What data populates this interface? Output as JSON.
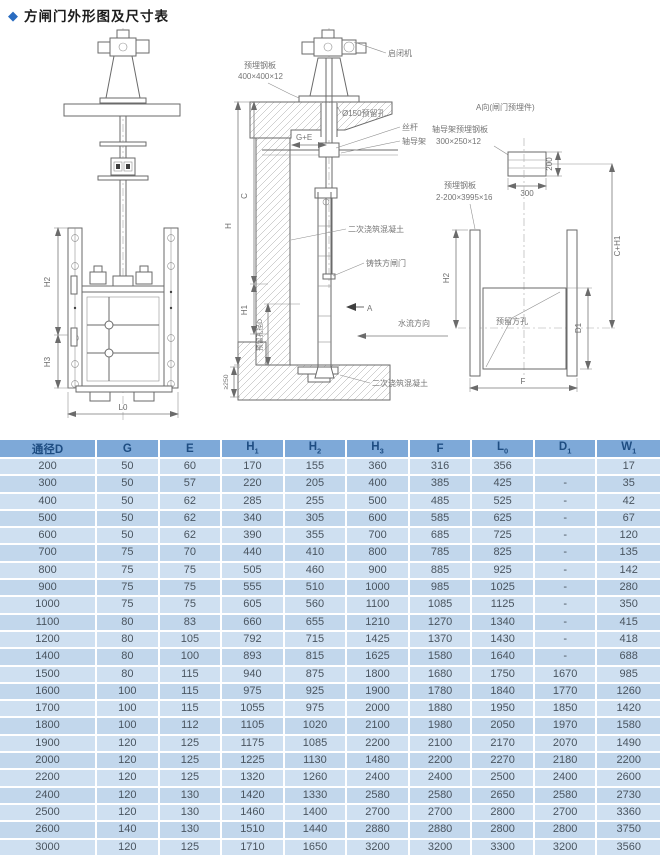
{
  "title": {
    "diamond": "◆",
    "text": "方闸门外形图及尺寸表"
  },
  "colors": {
    "header_bg": "#7ea9d8",
    "header_text": "#1e4d82",
    "row_odd": "#cfe0f1",
    "row_even": "#c2d7ec",
    "accent_diamond": "#2a6cc0"
  },
  "drawing": {
    "front": {
      "dim_h2": "H2",
      "dim_h3": "H3",
      "dim_l0": "L0"
    },
    "section": {
      "hoist": "启闭机",
      "embed_plate": "预埋钢板",
      "embed_plate_size": "400×400×12",
      "hole150": "Ø150预留孔",
      "ge": "G+E",
      "screw": "丝杆",
      "guide": "轴导架",
      "concrete_top": "二次浇筑混凝土",
      "gate": "铸铁方闸门",
      "a_mark": "A",
      "flow": "水流方向",
      "concrete_bottom": "二次浇筑混凝土",
      "dim_h": "H",
      "dim_c": "C",
      "dim_h1": "H1",
      "dim_hole": "预留孔径D",
      "dim_250": "≥250"
    },
    "aview": {
      "title": "A向(闸门预埋件)",
      "guide_plate": "轴导架预埋钢板",
      "guide_plate_size": "300×250×12",
      "embed_plate2": "预埋钢板",
      "embed_plate2_size": "2-200×3995×16",
      "hole_label": "预留方孔",
      "dim_300": "300",
      "dim_200": "200",
      "dim_ch1": "C+H1",
      "dim_h2": "H2",
      "dim_d1": "D1",
      "dim_f": "F"
    }
  },
  "table": {
    "headers": [
      {
        "t": "通径D",
        "s": ""
      },
      {
        "t": "G",
        "s": ""
      },
      {
        "t": "E",
        "s": ""
      },
      {
        "t": "H",
        "s": "1"
      },
      {
        "t": "H",
        "s": "2"
      },
      {
        "t": "H",
        "s": "3"
      },
      {
        "t": "F",
        "s": ""
      },
      {
        "t": "L",
        "s": "0"
      },
      {
        "t": "D",
        "s": "1"
      },
      {
        "t": "W",
        "s": "1"
      }
    ],
    "rows": [
      [
        200,
        50,
        60,
        170,
        155,
        360,
        316,
        356,
        "",
        17
      ],
      [
        300,
        50,
        57,
        220,
        205,
        400,
        385,
        425,
        "-",
        35
      ],
      [
        400,
        50,
        62,
        285,
        255,
        500,
        485,
        525,
        "-",
        42
      ],
      [
        500,
        50,
        62,
        340,
        305,
        600,
        585,
        625,
        "-",
        67
      ],
      [
        600,
        50,
        62,
        390,
        355,
        700,
        685,
        725,
        "-",
        120
      ],
      [
        700,
        75,
        70,
        440,
        410,
        800,
        785,
        825,
        "-",
        135
      ],
      [
        800,
        75,
        75,
        505,
        460,
        900,
        885,
        925,
        "-",
        142
      ],
      [
        900,
        75,
        75,
        555,
        510,
        1000,
        985,
        1025,
        "-",
        280
      ],
      [
        1000,
        75,
        75,
        605,
        560,
        1100,
        1085,
        1125,
        "-",
        350
      ],
      [
        1100,
        80,
        83,
        660,
        655,
        1210,
        1270,
        1340,
        "-",
        415
      ],
      [
        1200,
        80,
        105,
        792,
        715,
        1425,
        1370,
        1430,
        "-",
        418
      ],
      [
        1400,
        80,
        100,
        893,
        815,
        1625,
        1580,
        1640,
        "-",
        688
      ],
      [
        1500,
        80,
        115,
        940,
        875,
        1800,
        1680,
        1750,
        1670,
        985
      ],
      [
        1600,
        100,
        115,
        975,
        925,
        1900,
        1780,
        1840,
        1770,
        1260
      ],
      [
        1700,
        100,
        115,
        1055,
        975,
        2000,
        1880,
        1950,
        1850,
        1420
      ],
      [
        1800,
        100,
        112,
        1105,
        1020,
        2100,
        1980,
        2050,
        1970,
        1580
      ],
      [
        1900,
        120,
        125,
        1175,
        1085,
        2200,
        2100,
        2170,
        2070,
        1490
      ],
      [
        2000,
        120,
        125,
        1225,
        1130,
        1480,
        2200,
        2270,
        2180,
        2200
      ],
      [
        2200,
        120,
        125,
        1320,
        1260,
        2400,
        2400,
        2500,
        2400,
        2600
      ],
      [
        2400,
        120,
        130,
        1420,
        1330,
        2580,
        2580,
        2650,
        2580,
        2730
      ],
      [
        2500,
        120,
        130,
        1460,
        1400,
        2700,
        2700,
        2800,
        2700,
        3360
      ],
      [
        2600,
        140,
        130,
        1510,
        1440,
        2880,
        2880,
        2800,
        2800,
        3750
      ],
      [
        3000,
        120,
        125,
        1710,
        1650,
        3200,
        3200,
        3300,
        3200,
        3560
      ]
    ]
  }
}
